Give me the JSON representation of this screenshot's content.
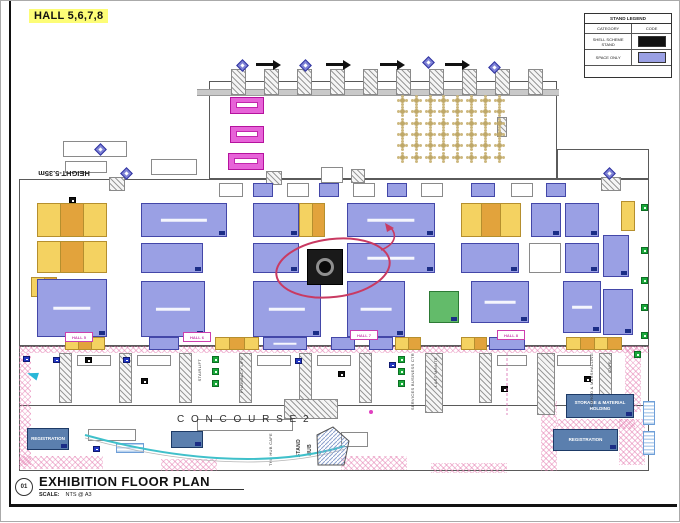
{
  "page": {
    "hall_title": "HALL 5,6,7,8"
  },
  "legend": {
    "title": "STAND LEGEND",
    "col_category": "CATEGORY",
    "col_code": "CODE",
    "rows": [
      {
        "label": "SHELL SCHEME STAND",
        "color": "#111111"
      },
      {
        "label": "SPACE ONLY",
        "color": "#9aa0e4"
      }
    ]
  },
  "titleblock": {
    "number": "01",
    "title": "EXHIBITION FLOOR PLAN",
    "scale_label": "SCALE:",
    "scale_value": "NTS @ A3"
  },
  "labels": {
    "concourse": "C O N C O U R S E   2",
    "height_note": "HEIGHT-5.35m",
    "hub_cafe": "THE HUB CAFE",
    "stand_hub_1": "STAND",
    "stand_hub_2": "HUB",
    "registration_left": "REGISTRATION",
    "registration_right": "REGISTRATION",
    "storage": "STORAGE & MATERIAL HOLDING",
    "hall_markers": [
      "HALL 5",
      "HALL 6",
      "HALL 7",
      "HALL 8"
    ],
    "services": [
      {
        "text": "STAIRLIFT",
        "x": 196,
        "y": 358
      },
      {
        "text": "PHARMACY LIFE",
        "x": 238,
        "y": 356
      },
      {
        "text": "SERVICES BUSINESS CTR",
        "x": 409,
        "y": 352
      },
      {
        "text": "LAST MINUTE",
        "x": 432,
        "y": 356
      },
      {
        "text": "CARGO & MARSHALLING",
        "x": 588,
        "y": 352
      },
      {
        "text": "CAFE",
        "x": 606,
        "y": 360
      }
    ]
  },
  "colors": {
    "annotation": "#c93a62",
    "arc": "#3fc0ca",
    "pink_hatch": "#e47eb1",
    "tag": "#1b2d86",
    "stand": {
      "p": {
        "f": "#9aa0e4",
        "b": "#4347a8"
      },
      "y": {
        "f": "#f4d261",
        "b": "#b58f2e",
        "alt": "#e2a33c"
      },
      "w": {
        "f": "#ffffff",
        "b": "#8a8a8a"
      },
      "k": {
        "f": "#e763d8",
        "b": "#b5129e"
      },
      "g": {
        "f": "#63bb6a",
        "b": "#2d7a35"
      },
      "s": {
        "f": "#5b7fae",
        "b": "#1d3a66"
      }
    }
  },
  "plan": {
    "walls": [
      [
        208,
        80,
        348,
        98
      ],
      [
        556,
        148,
        92,
        30
      ],
      [
        18,
        178,
        630,
        167
      ],
      [
        18,
        345,
        630,
        60
      ],
      [
        18,
        345,
        630,
        125
      ]
    ],
    "gray_band": [
      196,
      88,
      362,
      5
    ],
    "stands": [
      [
        229,
        96,
        34,
        17,
        "k",
        0,
        0,
        0
      ],
      [
        229,
        125,
        34,
        17,
        "k",
        0,
        0,
        0
      ],
      [
        227,
        152,
        36,
        17,
        "k",
        0,
        0,
        0
      ],
      [
        36,
        202,
        70,
        34,
        "y",
        3,
        0,
        0
      ],
      [
        36,
        240,
        70,
        32,
        "y",
        3,
        0,
        0
      ],
      [
        30,
        276,
        26,
        20,
        "y",
        2,
        0,
        0
      ],
      [
        140,
        202,
        86,
        34,
        "p",
        0,
        1,
        1
      ],
      [
        252,
        202,
        46,
        34,
        "p",
        0,
        1,
        0
      ],
      [
        298,
        202,
        26,
        34,
        "y",
        2,
        0,
        0
      ],
      [
        346,
        202,
        88,
        34,
        "p",
        0,
        1,
        1
      ],
      [
        460,
        202,
        60,
        34,
        "y",
        3,
        0,
        0
      ],
      [
        530,
        202,
        30,
        34,
        "p",
        0,
        1,
        0
      ],
      [
        564,
        202,
        34,
        34,
        "p",
        0,
        1,
        0
      ],
      [
        140,
        242,
        62,
        30,
        "p",
        0,
        1,
        0
      ],
      [
        252,
        242,
        46,
        30,
        "p",
        0,
        1,
        0
      ],
      [
        346,
        242,
        88,
        30,
        "p",
        0,
        1,
        1
      ],
      [
        460,
        242,
        58,
        30,
        "p",
        0,
        1,
        0
      ],
      [
        528,
        242,
        32,
        30,
        "w",
        0,
        0,
        0
      ],
      [
        564,
        242,
        34,
        30,
        "p",
        0,
        1,
        0
      ],
      [
        36,
        278,
        70,
        58,
        "p",
        0,
        1,
        1
      ],
      [
        140,
        280,
        64,
        56,
        "p",
        0,
        1,
        1
      ],
      [
        252,
        280,
        68,
        56,
        "p",
        0,
        1,
        1
      ],
      [
        346,
        280,
        58,
        56,
        "p",
        0,
        1,
        1
      ],
      [
        428,
        290,
        30,
        32,
        "g",
        0,
        1,
        0
      ],
      [
        470,
        280,
        58,
        42,
        "p",
        0,
        1,
        1
      ],
      [
        562,
        280,
        38,
        52,
        "p",
        0,
        1,
        1
      ],
      [
        620,
        200,
        14,
        30,
        "y",
        0,
        0,
        0
      ],
      [
        602,
        234,
        26,
        42,
        "p",
        0,
        1,
        0
      ],
      [
        602,
        288,
        30,
        46,
        "p",
        0,
        1,
        0
      ],
      [
        218,
        182,
        24,
        14,
        "w",
        0,
        0,
        0
      ],
      [
        252,
        182,
        20,
        14,
        "p",
        0,
        0,
        0
      ],
      [
        286,
        182,
        22,
        14,
        "w",
        0,
        0,
        0
      ],
      [
        318,
        182,
        20,
        14,
        "p",
        0,
        0,
        0
      ],
      [
        352,
        182,
        22,
        14,
        "w",
        0,
        0,
        0
      ],
      [
        386,
        182,
        20,
        14,
        "p",
        0,
        0,
        0
      ],
      [
        420,
        182,
        22,
        14,
        "w",
        0,
        0,
        0
      ],
      [
        470,
        182,
        24,
        14,
        "p",
        0,
        0,
        0
      ],
      [
        510,
        182,
        22,
        14,
        "w",
        0,
        0,
        0
      ],
      [
        545,
        182,
        20,
        14,
        "p",
        0,
        0,
        0
      ],
      [
        62,
        140,
        64,
        16,
        "w",
        0,
        0,
        0
      ],
      [
        64,
        160,
        42,
        12,
        "w",
        0,
        0,
        0
      ],
      [
        150,
        158,
        46,
        16,
        "w",
        0,
        0,
        0
      ],
      [
        320,
        166,
        22,
        16,
        "w",
        0,
        0,
        0
      ],
      [
        64,
        336,
        40,
        13,
        "y",
        3,
        0,
        0
      ],
      [
        148,
        336,
        30,
        13,
        "p",
        0,
        0,
        0
      ],
      [
        214,
        336,
        44,
        13,
        "y",
        3,
        0,
        0
      ],
      [
        262,
        336,
        44,
        13,
        "p",
        0,
        0,
        1
      ],
      [
        330,
        336,
        24,
        13,
        "p",
        0,
        0,
        0
      ],
      [
        368,
        336,
        24,
        13,
        "p",
        0,
        0,
        0
      ],
      [
        394,
        336,
        26,
        13,
        "y",
        2,
        0,
        0
      ],
      [
        460,
        336,
        26,
        13,
        "y",
        2,
        0,
        0
      ],
      [
        488,
        336,
        36,
        13,
        "p",
        0,
        0,
        0
      ],
      [
        565,
        336,
        56,
        13,
        "y",
        4,
        0,
        0
      ],
      [
        76,
        354,
        34,
        11,
        "w",
        0,
        0,
        0
      ],
      [
        136,
        354,
        34,
        11,
        "w",
        0,
        0,
        0
      ],
      [
        256,
        354,
        34,
        11,
        "w",
        0,
        0,
        0
      ],
      [
        316,
        354,
        34,
        11,
        "w",
        0,
        0,
        0
      ],
      [
        496,
        354,
        30,
        11,
        "w",
        0,
        0,
        0
      ],
      [
        556,
        354,
        34,
        11,
        "w",
        0,
        0,
        0
      ],
      [
        87,
        428,
        48,
        12,
        "w",
        0,
        0,
        0
      ],
      [
        196,
        418,
        96,
        12,
        "w",
        0,
        0,
        0
      ],
      [
        340,
        431,
        27,
        15,
        "w",
        0,
        0,
        0
      ]
    ],
    "black_stand": [
      306,
      248,
      36,
      36
    ],
    "offices": [
      [
        26,
        427,
        42,
        22,
        "registration_left"
      ],
      [
        170,
        430,
        32,
        17,
        ""
      ],
      [
        565,
        393,
        68,
        24,
        "storage"
      ],
      [
        552,
        428,
        65,
        22,
        "registration_right"
      ]
    ],
    "bluegrids": [
      [
        115,
        442,
        28,
        10
      ],
      [
        642,
        400,
        12,
        24
      ],
      [
        642,
        430,
        12,
        24
      ]
    ],
    "hatch_blocks": [
      [
        230,
        68,
        15,
        26
      ],
      [
        263,
        68,
        15,
        26
      ],
      [
        296,
        68,
        15,
        26
      ],
      [
        329,
        68,
        15,
        26
      ],
      [
        362,
        68,
        15,
        26
      ],
      [
        395,
        68,
        15,
        26
      ],
      [
        428,
        68,
        15,
        26
      ],
      [
        461,
        68,
        15,
        26
      ],
      [
        494,
        68,
        15,
        26
      ],
      [
        527,
        68,
        15,
        26
      ],
      [
        58,
        352,
        13,
        50
      ],
      [
        118,
        352,
        13,
        50
      ],
      [
        178,
        352,
        13,
        50
      ],
      [
        238,
        352,
        13,
        50
      ],
      [
        298,
        352,
        13,
        50
      ],
      [
        358,
        352,
        13,
        50
      ],
      [
        478,
        352,
        13,
        50
      ],
      [
        598,
        352,
        13,
        50
      ],
      [
        424,
        352,
        18,
        60
      ],
      [
        536,
        352,
        18,
        62
      ],
      [
        283,
        398,
        54,
        20
      ],
      [
        496,
        116,
        10,
        20
      ],
      [
        265,
        170,
        16,
        14
      ],
      [
        350,
        168,
        14,
        14
      ],
      [
        108,
        176,
        16,
        14
      ],
      [
        600,
        176,
        20,
        14
      ]
    ],
    "pink_hatches": [
      [
        18,
        345,
        630,
        7
      ],
      [
        18,
        352,
        12,
        112
      ],
      [
        624,
        345,
        16,
        66
      ],
      [
        540,
        400,
        16,
        70
      ],
      [
        18,
        455,
        84,
        13
      ],
      [
        160,
        458,
        56,
        12
      ],
      [
        340,
        455,
        66,
        14
      ],
      [
        430,
        462,
        76,
        10
      ],
      [
        618,
        418,
        26,
        46
      ],
      [
        556,
        418,
        78,
        10
      ]
    ],
    "diamonds": [
      [
        237,
        60
      ],
      [
        300,
        60
      ],
      [
        423,
        57
      ],
      [
        489,
        62
      ],
      [
        95,
        144
      ],
      [
        121,
        168
      ],
      [
        604,
        168
      ]
    ],
    "arrows": [
      [
        255,
        62
      ],
      [
        325,
        62
      ],
      [
        379,
        62
      ],
      [
        444,
        62
      ]
    ],
    "green_icons": [
      [
        640,
        203
      ],
      [
        640,
        246
      ],
      [
        640,
        276
      ],
      [
        640,
        303
      ],
      [
        640,
        331
      ],
      [
        211,
        355
      ],
      [
        211,
        367
      ],
      [
        211,
        379
      ],
      [
        397,
        355
      ],
      [
        397,
        367
      ],
      [
        397,
        379
      ],
      [
        633,
        350
      ]
    ],
    "black_icons": [
      [
        84,
        356
      ],
      [
        140,
        377
      ],
      [
        337,
        370
      ],
      [
        500,
        385
      ],
      [
        583,
        375
      ],
      [
        68,
        196
      ]
    ],
    "blue_icons": [
      [
        22,
        355
      ],
      [
        52,
        356
      ],
      [
        122,
        356
      ],
      [
        294,
        357
      ],
      [
        388,
        361
      ],
      [
        92,
        445
      ]
    ],
    "cyan_arrow": [
      26,
      370
    ],
    "tables_grid": {
      "x": 399,
      "y": 97,
      "cols": 8,
      "rows": 6,
      "dx": 13.8,
      "dy": 11.3
    },
    "hall_marker_pos": [
      [
        64,
        331
      ],
      [
        182,
        331
      ],
      [
        349,
        329
      ],
      [
        496,
        329
      ]
    ]
  }
}
